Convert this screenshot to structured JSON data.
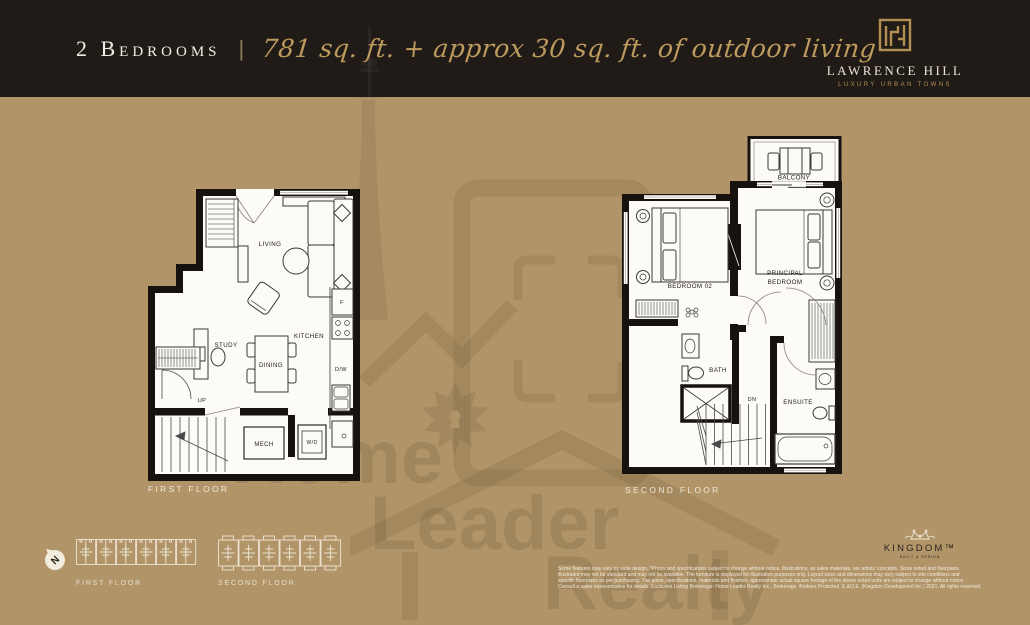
{
  "header": {
    "bedrooms_label": "2 Bedrooms",
    "separator": "|",
    "area_label": "781 sq. ft. + approx 30 sq. ft. of outdoor living",
    "logo": {
      "name": "LAWRENCE HILL",
      "tagline": "LUXURY URBAN TOWNS"
    }
  },
  "colors": {
    "background": "#b19569",
    "header_bg": "#211b17",
    "gold": "#bd9a5e",
    "cream": "#f0e8d6",
    "wall": "#17120e",
    "plan_floor": "#fcfbf7",
    "watermark_ink": "#7a6136"
  },
  "first_floor": {
    "caption": "FIRST FLOOR",
    "rooms": {
      "living": "LIVING",
      "study": "STUDY",
      "dining": "DINING",
      "kitchen": "KITCHEN",
      "mech": "MECH",
      "wd": "W/D",
      "fridge": "F",
      "dw": "D/W",
      "up": "UP"
    }
  },
  "second_floor": {
    "caption": "SECOND FLOOR",
    "rooms": {
      "balcony": "BALCONY",
      "bedroom2": "BEDROOM 02",
      "principal_line1": "PRINCIPAL",
      "principal_line2": "BEDROOM",
      "bath": "BATH",
      "ensuite": "ENSUITE",
      "dn": "DN"
    }
  },
  "keyplans": {
    "compass": "N",
    "first_caption": "FIRST FLOOR",
    "second_caption": "SECOND FLOOR"
  },
  "watermark": {
    "word1": "Home",
    "word2": "Leader",
    "word3": "Realty"
  },
  "footer": {
    "kingdom": {
      "name": "KINGDOM™",
      "tagline": "BUILT & DESIGN"
    },
    "disclaimer_lines": [
      "Some features may vary by suite design. *Prices and specifications subject to change without notice. Illustrations, as sales materials, are artists' concepts. Sizes noted and floorplans",
      "illustrated may not be standard and may not be available. The furniture is displayed for illustration purposes only. Layout sizes and dimensions may vary subject to site conditions and",
      "specific floorplans as per purchasing. The plans, specifications, materials and finishes, approximate actual square footage of the above noted units are subject to change without notice.",
      "Consult a sales representative for details. Exclusive Listing Brokerage: Home Leader Realty Inc., Brokerage. Brokers Protected. E.&O.E. (Kingdom Development Inc.) 2021. All rights reserved."
    ]
  }
}
